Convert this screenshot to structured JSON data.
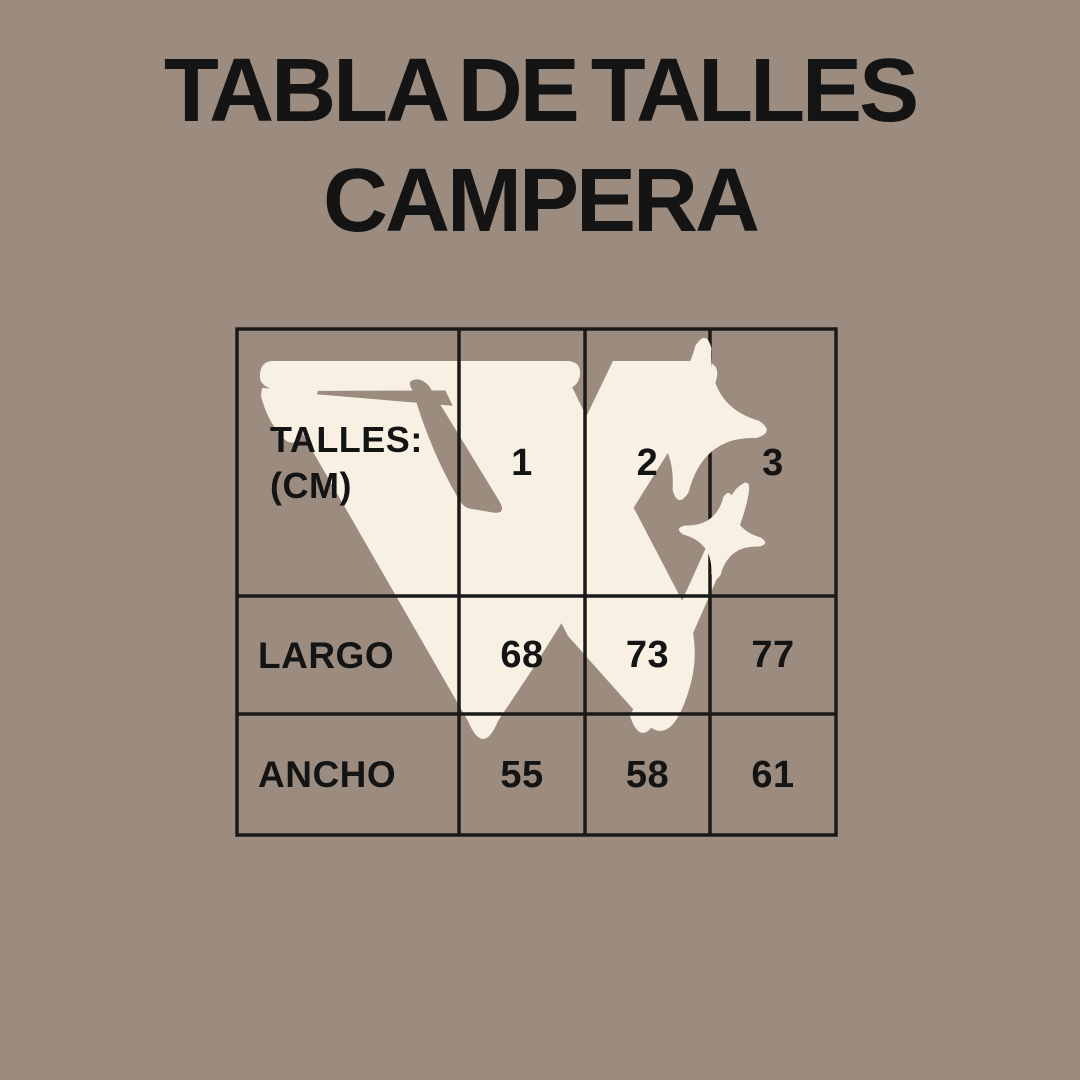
{
  "title": {
    "line1": "TABLA DE TALLES",
    "line2": "CAMPERA"
  },
  "chart_data": {
    "type": "table",
    "title": "TABLA DE TALLES CAMPERA",
    "header": {
      "label_line1": "TALLES:",
      "label_line2": "(CM)",
      "columns": [
        "1",
        "2",
        "3"
      ]
    },
    "rows": [
      {
        "label": "LARGO",
        "values": [
          "68",
          "73",
          "77"
        ]
      },
      {
        "label": "ANCHO",
        "values": [
          "55",
          "58",
          "61"
        ]
      }
    ],
    "unit_note": "(CM)"
  },
  "watermark": {
    "letter": "W",
    "icons": [
      "sparkle-large-icon",
      "sparkle-small-icon"
    ]
  },
  "colors": {
    "background": "#9c8c7f",
    "cream": "#f8f1e3",
    "grid": "#1a1a1a",
    "text": "#141414"
  }
}
